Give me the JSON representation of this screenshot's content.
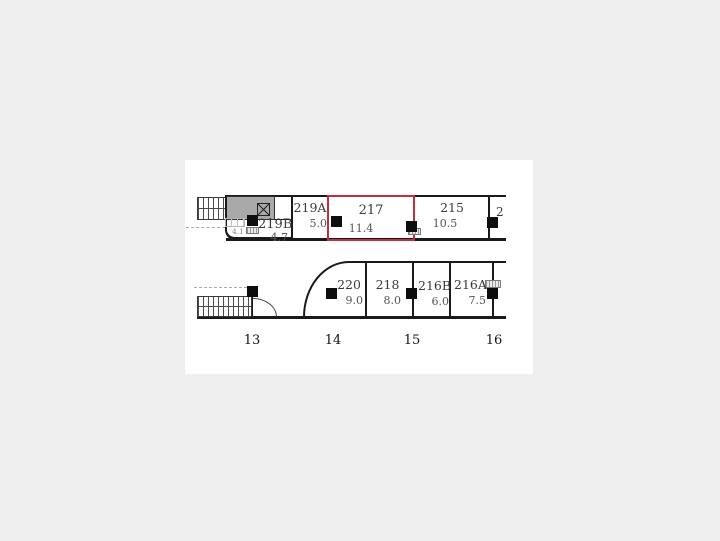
{
  "floor_plan": {
    "colors": {
      "highlight": "#c0303c",
      "wall": "#1a1a1a",
      "room_fill_gray": "#a9a9a9",
      "page_background": "#efefef"
    },
    "upper_band": {
      "rooms": [
        {
          "number": "219A",
          "area": "5.0"
        },
        {
          "number": "217",
          "area": "11.4",
          "highlighted": true
        },
        {
          "number": "215",
          "area": "10.5"
        },
        {
          "number": "2"
        }
      ],
      "room_219b": {
        "number": "219B",
        "area": "4.7"
      },
      "small_room_area": "4.1"
    },
    "lower_band": {
      "rooms": [
        {
          "number": "220",
          "area": "9.0"
        },
        {
          "number": "218",
          "area": "8.0"
        },
        {
          "number": "216B",
          "area": "6.0"
        },
        {
          "number": "216A",
          "area": "7.5"
        }
      ]
    },
    "grid_columns": [
      "13",
      "14",
      "15",
      "16"
    ]
  }
}
